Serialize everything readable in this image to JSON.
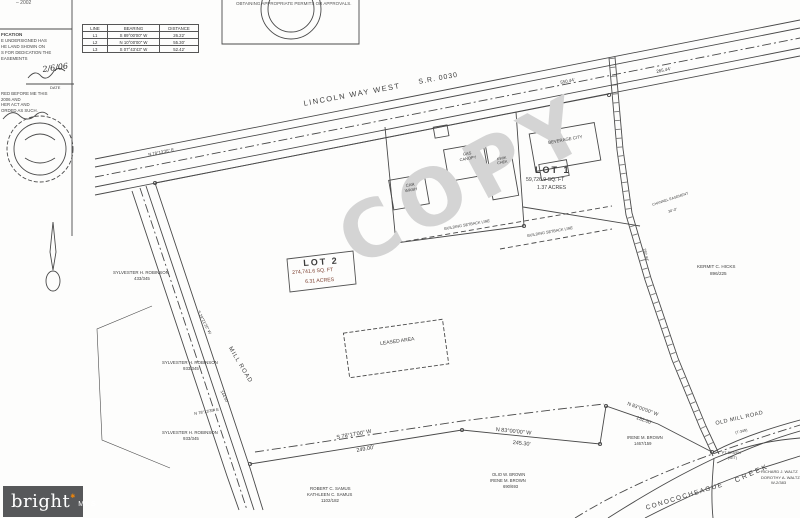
{
  "watermark": "COPY",
  "header_note": "OBTAINING APPROPRIATE PERMITS OR APPROVALS.",
  "left_panel": {
    "year_note": "– 2002",
    "cert_title": "FICATION",
    "cert_lines": [
      "E UNDERSIGNED HAS",
      "HE LAND SHOWN ON",
      "S FOR DEDICATION THE",
      "EASEMENTS"
    ],
    "date_script": "2/6/06",
    "date_label": "DATE",
    "notary_lines": [
      "RED BEFORE ME THIS",
      "2006 AND",
      "HER ACT AND",
      "ORDED AS SUCH."
    ]
  },
  "line_table": {
    "headers": [
      "LINE",
      "BEARING",
      "DISTANCE"
    ],
    "rows": [
      {
        "line": "L1",
        "bearing": "S 89°00'00\" W",
        "distance": "26.22'"
      },
      {
        "line": "L2",
        "bearing": "N 10°00'00\" W",
        "distance": "55.30'"
      },
      {
        "line": "L3",
        "bearing": "S 07°43'43\" W",
        "distance": "52.42'"
      }
    ]
  },
  "roads": {
    "lincoln": "LINCOLN WAY WEST",
    "sr": "S.R. 0030",
    "mill": "MILL ROAD",
    "old_mill": "OLD MILL ROAD",
    "old_mill_num": "(T-349)",
    "creek_word": "CREEK",
    "creek_name": "CONOCOCHEAGUE"
  },
  "lots": {
    "lot1": {
      "title": "LOT 1",
      "area": "59,726.9 SQ. FT",
      "acres": "1.37 ACRES"
    },
    "lot2": {
      "title": "LOT 2",
      "area": "274,741.6 SQ. FT",
      "acres": "6.31 ACRES"
    }
  },
  "buildings": {
    "beverage": "BEVERAGE CITY",
    "car_wash": "CAR WASH",
    "gas_canopy": "GAS CANOPY",
    "kwik": "KWIK CHEK",
    "leased": "LEASED AREA",
    "setback": "BUILDING SETBACK LINE"
  },
  "bearings": {
    "top_road": "N 78°13'35\" E",
    "top_d1": "550.44'",
    "top_d2": "265.44'",
    "mill": "S 29°21'25\" W",
    "mill_d": "144.50'",
    "sw": "N 78°13'35\" E",
    "b1": "S 78°17'00\" W",
    "b1d": "249.00'",
    "b2": "N 83°00'00\" W",
    "b2d": "245.30'",
    "b3": "N 83°00'00\" W",
    "b3d": "132.00'",
    "ch_d": "282.44'",
    "channel": "CHANNEL EASEMENT",
    "channel_w": "30'-0\""
  },
  "owners": {
    "robinson1": [
      "SYLVESTER H. ROBINSON",
      "433/345"
    ],
    "robinson2": [
      "SYLVESTER H. ROBINSON",
      "933/345"
    ],
    "robinson3": [
      "SYLVESTER H. ROBINSON",
      "933/345"
    ],
    "brown": [
      "OLIO W. BROWN",
      "IRENE M. BROWN",
      "690/693"
    ],
    "samus": [
      "ROBERT C. SAMUS",
      "KATHLEEN C. SAMUS",
      "1102/182"
    ],
    "irene": [
      "IRENE M. BROWN",
      "1467/159"
    ],
    "hicks": [
      "KERMIT C. HICKS",
      "896/225"
    ],
    "waltz": [
      "RICHARD J. WALTZ",
      "DOROTHY A. WALTZ",
      "W-2/383"
    ]
  },
  "markers": {
    "pin1": "PT. DRIVEN",
    "pin2": "(SET)"
  },
  "logo": {
    "word": "bright",
    "star": "✱",
    "suffix": "MLS"
  }
}
